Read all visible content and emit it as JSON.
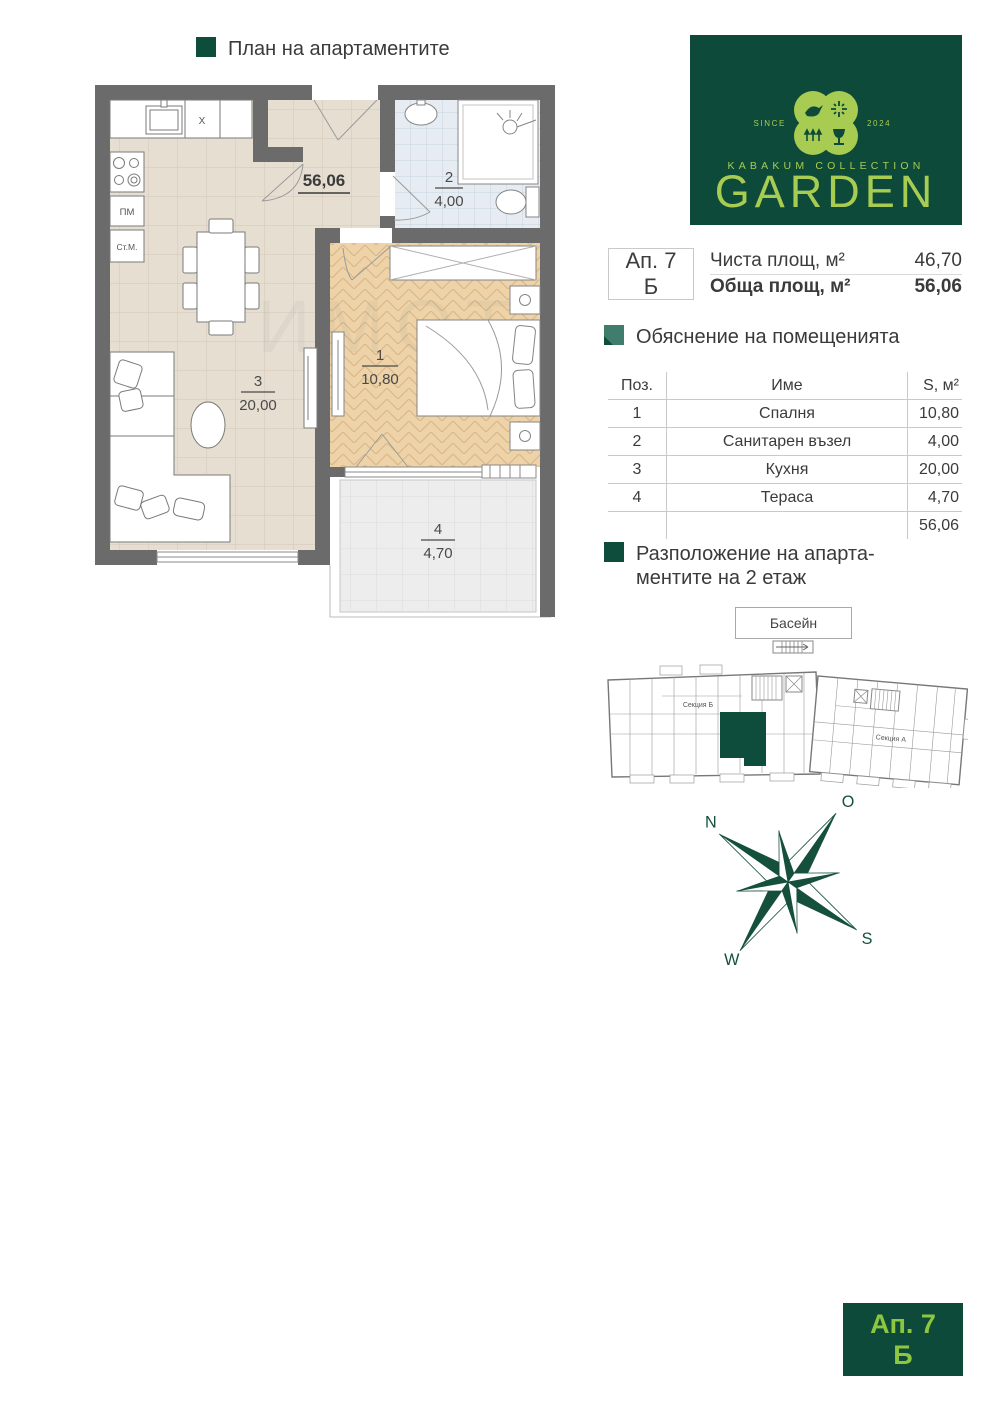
{
  "header": {
    "title": "План на апартаментите"
  },
  "logo": {
    "since": "SINCE",
    "year": "2024",
    "collection": "KABAKUM COLLECTION",
    "name": "GARDEN",
    "bg_color": "#0d4a39",
    "fg_color": "#a8cc52"
  },
  "apartment_info": {
    "apt": "Ап. 7",
    "section": "Б",
    "net_label": "Чиста площ, м²",
    "net_value": "46,70",
    "total_label": "Обща площ, м²",
    "total_value": "56,06"
  },
  "rooms_section": {
    "title": "Обяснение на помещенията",
    "table": {
      "headers": [
        "Поз.",
        "Име",
        "S, м²"
      ],
      "rows": [
        [
          "1",
          "Спалня",
          "10,80"
        ],
        [
          "2",
          "Санитарен възел",
          "4,00"
        ],
        [
          "3",
          "Кухня",
          "20,00"
        ],
        [
          "4",
          "Тераса",
          "4,70"
        ]
      ],
      "total": "56,06"
    }
  },
  "location_section": {
    "title_line1": "Разположение на апарта-",
    "title_line2": "ментите на 2 етаж",
    "pool_label": "Басейн",
    "section_b": "Секция Б",
    "section_a": "Секция А",
    "highlight_color": "#0e4c3b"
  },
  "floor_plan": {
    "total_area": "56,06",
    "bedroom": {
      "num": "1",
      "area": "10,80"
    },
    "bath": {
      "num": "2",
      "area": "4,00"
    },
    "kitchen": {
      "num": "3",
      "area": "20,00"
    },
    "terrace": {
      "num": "4",
      "area": "4,70"
    },
    "labels": {
      "hob": "X",
      "dishwasher": "ПМ",
      "washer": "Ст.М."
    },
    "watermark": "ИМОТ"
  },
  "compass": {
    "n": "N",
    "e": "O",
    "s": "S",
    "w": "W",
    "color": "#14503c"
  },
  "badge": {
    "apt": "Ап. 7",
    "section": "Б"
  }
}
